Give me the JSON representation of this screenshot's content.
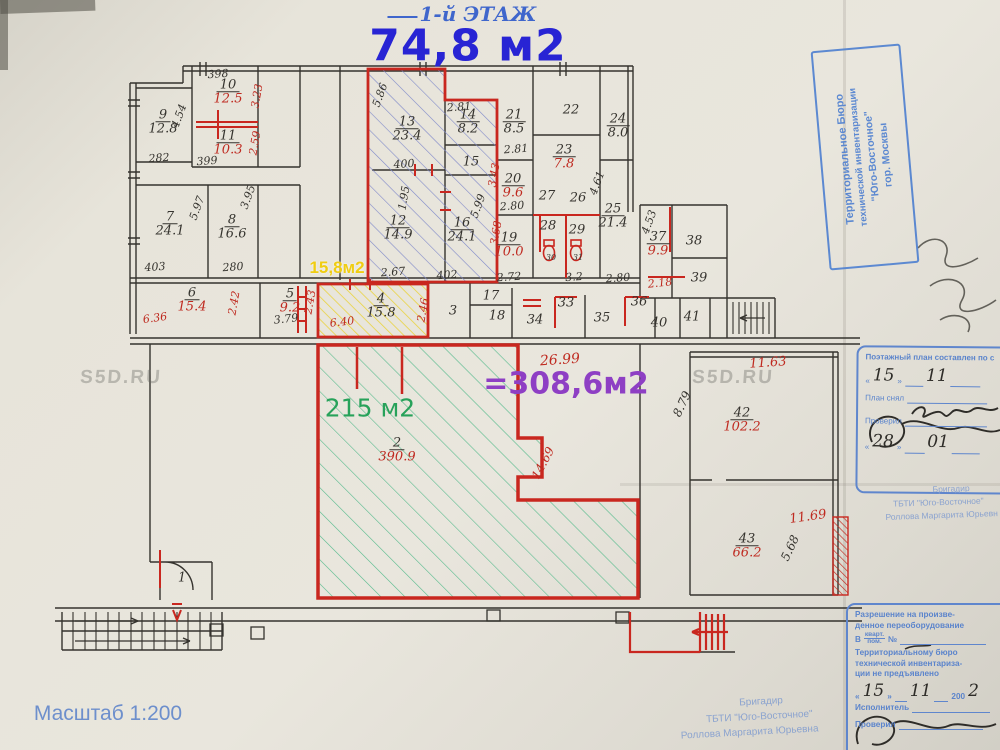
{
  "page": {
    "floor_label": "1-й ЭТАЖ",
    "floor_area": "74,8 м2",
    "scale_label": "Масштаб 1:200",
    "watermark": "S5D.RU"
  },
  "palette": {
    "ink": "#35332e",
    "red": "#bf2a20",
    "hand_blue": "#3f66cc",
    "stamp_blue": "#5b84cc",
    "green": "#27a25a",
    "purple": "#8e3fc4",
    "yellow": "#f0cd12"
  },
  "highlights": {
    "yellow_area": "15,8м2",
    "green_area": "215 м2",
    "purple_total": "=308,6м2"
  },
  "plan": {
    "rooms": [
      {
        "n": "9",
        "a": "12.8",
        "c": "ink",
        "x": 163,
        "y": 122
      },
      {
        "n": "10",
        "a": "12.5",
        "c": "red",
        "x": 228,
        "y": 92
      },
      {
        "n": "11",
        "a": "10.3",
        "c": "red",
        "x": 228,
        "y": 143
      },
      {
        "n": "7",
        "a": "24.1",
        "c": "ink",
        "x": 170,
        "y": 224
      },
      {
        "n": "8",
        "a": "16.6",
        "c": "ink",
        "x": 232,
        "y": 227
      },
      {
        "n": "13",
        "a": "23.4",
        "c": "ink",
        "x": 407,
        "y": 129
      },
      {
        "n": "14",
        "a": "8.2",
        "c": "ink",
        "x": 468,
        "y": 122
      },
      {
        "n": "15",
        "a": "",
        "c": "ink",
        "x": 471,
        "y": 162
      },
      {
        "n": "12",
        "a": "14.9",
        "c": "ink",
        "x": 398,
        "y": 228
      },
      {
        "n": "16",
        "a": "24.1",
        "c": "ink",
        "x": 462,
        "y": 230
      },
      {
        "n": "21",
        "a": "8.5",
        "c": "ink",
        "x": 514,
        "y": 122
      },
      {
        "n": "22",
        "a": "",
        "c": "ink",
        "x": 571,
        "y": 110
      },
      {
        "n": "23",
        "a": "7.8",
        "c": "red",
        "x": 564,
        "y": 157
      },
      {
        "n": "24",
        "a": "8.0",
        "c": "ink",
        "x": 618,
        "y": 126
      },
      {
        "n": "20",
        "a": "9.6",
        "c": "red",
        "x": 513,
        "y": 186
      },
      {
        "n": "27",
        "a": "",
        "c": "ink",
        "x": 547,
        "y": 196
      },
      {
        "n": "26",
        "a": "",
        "c": "ink",
        "x": 578,
        "y": 198
      },
      {
        "n": "25",
        "a": "21.4",
        "c": "ink",
        "x": 613,
        "y": 216
      },
      {
        "n": "19",
        "a": "10.0",
        "c": "red",
        "x": 509,
        "y": 245
      },
      {
        "n": "28",
        "a": "",
        "c": "ink",
        "x": 548,
        "y": 226
      },
      {
        "n": "29",
        "a": "",
        "c": "ink",
        "x": 577,
        "y": 230
      },
      {
        "n": "30",
        "a": "",
        "c": "ink",
        "x": 551,
        "y": 258,
        "s": 8
      },
      {
        "n": "31",
        "a": "",
        "c": "ink",
        "x": 578,
        "y": 258,
        "s": 8
      },
      {
        "n": "37",
        "a": "9.9",
        "c": "red",
        "x": 658,
        "y": 244
      },
      {
        "n": "38",
        "a": "",
        "c": "ink",
        "x": 694,
        "y": 241
      },
      {
        "n": "39",
        "a": "",
        "c": "ink",
        "x": 699,
        "y": 278
      },
      {
        "n": "6",
        "a": "15.4",
        "c": "red",
        "x": 192,
        "y": 300
      },
      {
        "n": "5",
        "a": "9.2",
        "c": "red",
        "x": 290,
        "y": 301
      },
      {
        "n": "4",
        "a": "15.8",
        "c": "ink",
        "x": 381,
        "y": 306
      },
      {
        "n": "3",
        "a": "",
        "c": "ink",
        "x": 453,
        "y": 311
      },
      {
        "n": "17",
        "a": "",
        "c": "ink",
        "x": 491,
        "y": 296
      },
      {
        "n": "18",
        "a": "",
        "c": "ink",
        "x": 497,
        "y": 316
      },
      {
        "n": "34",
        "a": "",
        "c": "ink",
        "x": 535,
        "y": 320
      },
      {
        "n": "33",
        "a": "",
        "c": "ink",
        "x": 566,
        "y": 303
      },
      {
        "n": "35",
        "a": "",
        "c": "ink",
        "x": 602,
        "y": 318
      },
      {
        "n": "36",
        "a": "",
        "c": "ink",
        "x": 639,
        "y": 302
      },
      {
        "n": "40",
        "a": "",
        "c": "ink",
        "x": 659,
        "y": 323
      },
      {
        "n": "41",
        "a": "",
        "c": "ink",
        "x": 692,
        "y": 317
      },
      {
        "n": "2",
        "a": "390.9",
        "c": "red",
        "x": 397,
        "y": 450
      },
      {
        "n": "42",
        "a": "102.2",
        "c": "red",
        "x": 742,
        "y": 420
      },
      {
        "n": "43",
        "a": "66.2",
        "c": "red",
        "x": 747,
        "y": 546
      },
      {
        "n": "1",
        "a": "",
        "c": "ink",
        "x": 182,
        "y": 578
      }
    ],
    "dims": [
      {
        "t": "398",
        "x": 218,
        "y": 74,
        "c": "ink",
        "r": -4
      },
      {
        "t": "3.23",
        "x": 257,
        "y": 96,
        "c": "red",
        "r": -80
      },
      {
        "t": "4.54",
        "x": 179,
        "y": 116,
        "c": "ink",
        "r": -70
      },
      {
        "t": "2.59",
        "x": 255,
        "y": 143,
        "c": "red",
        "r": -80
      },
      {
        "t": "282",
        "x": 159,
        "y": 158,
        "c": "ink",
        "r": -4
      },
      {
        "t": "399",
        "x": 207,
        "y": 161,
        "c": "ink",
        "r": -4
      },
      {
        "t": "5.97",
        "x": 197,
        "y": 208,
        "c": "ink",
        "r": -70
      },
      {
        "t": "3.95",
        "x": 248,
        "y": 197,
        "c": "ink",
        "r": -70
      },
      {
        "t": "403",
        "x": 155,
        "y": 267,
        "c": "ink",
        "r": -4
      },
      {
        "t": "280",
        "x": 233,
        "y": 267,
        "c": "ink",
        "r": -4
      },
      {
        "t": "5.86",
        "x": 380,
        "y": 95,
        "c": "ink",
        "r": -70
      },
      {
        "t": "400",
        "x": 404,
        "y": 164,
        "c": "ink",
        "r": -4
      },
      {
        "t": "2.81",
        "x": 459,
        "y": 107,
        "c": "ink",
        "r": -4
      },
      {
        "t": "1.95",
        "x": 404,
        "y": 198,
        "c": "ink",
        "r": -80
      },
      {
        "t": "5.99",
        "x": 478,
        "y": 206,
        "c": "ink",
        "r": -70
      },
      {
        "t": "2.67",
        "x": 393,
        "y": 272,
        "c": "ink",
        "r": -4
      },
      {
        "t": "402",
        "x": 447,
        "y": 275,
        "c": "ink",
        "r": -4
      },
      {
        "t": "3.43",
        "x": 494,
        "y": 175,
        "c": "red",
        "r": -80
      },
      {
        "t": "3.68",
        "x": 496,
        "y": 233,
        "c": "red",
        "r": -80
      },
      {
        "t": "2.81",
        "x": 516,
        "y": 149,
        "c": "ink",
        "r": -4
      },
      {
        "t": "2.80",
        "x": 512,
        "y": 206,
        "c": "ink",
        "r": -4
      },
      {
        "t": "4.61",
        "x": 597,
        "y": 183,
        "c": "ink",
        "r": -70
      },
      {
        "t": "2.72",
        "x": 509,
        "y": 277,
        "c": "ink",
        "r": -4
      },
      {
        "t": "3.2",
        "x": 574,
        "y": 277,
        "c": "ink",
        "r": -4
      },
      {
        "t": "2.80",
        "x": 618,
        "y": 278,
        "c": "ink",
        "r": -4
      },
      {
        "t": "4.53",
        "x": 649,
        "y": 222,
        "c": "ink",
        "r": -70
      },
      {
        "t": "2.18",
        "x": 660,
        "y": 283,
        "c": "red",
        "r": -6
      },
      {
        "t": "6.36",
        "x": 155,
        "y": 318,
        "c": "red",
        "r": -8
      },
      {
        "t": "2.42",
        "x": 234,
        "y": 303,
        "c": "red",
        "r": -80
      },
      {
        "t": "3.79",
        "x": 286,
        "y": 319,
        "c": "ink",
        "r": -6
      },
      {
        "t": "2.43",
        "x": 310,
        "y": 302,
        "c": "red",
        "r": -80
      },
      {
        "t": "6.40",
        "x": 342,
        "y": 322,
        "c": "red",
        "r": -6
      },
      {
        "t": "2.46",
        "x": 423,
        "y": 310,
        "c": "red",
        "r": -80
      },
      {
        "t": "26.99",
        "x": 560,
        "y": 360,
        "c": "red",
        "r": -4,
        "s": 14
      },
      {
        "t": "11.63",
        "x": 768,
        "y": 363,
        "c": "red",
        "r": -4,
        "s": 13
      },
      {
        "t": "8.79",
        "x": 682,
        "y": 404,
        "c": "ink",
        "r": -65,
        "s": 12
      },
      {
        "t": "11.69",
        "x": 808,
        "y": 517,
        "c": "red",
        "r": -8,
        "s": 13
      },
      {
        "t": "5.68",
        "x": 790,
        "y": 548,
        "c": "ink",
        "r": -65,
        "s": 12
      },
      {
        "t": "14.69",
        "x": 543,
        "y": 463,
        "c": "red",
        "r": -62,
        "s": 12
      }
    ]
  },
  "watermarks": [
    {
      "x": 121,
      "y": 378
    },
    {
      "x": 733,
      "y": 378
    }
  ],
  "stamps": {
    "top_right": {
      "lines": [
        "Территориальное Бюро",
        "технической инвентаризации",
        "\"Юго-Восточное\"",
        "гор. Москвы"
      ]
    },
    "plan_box": {
      "title": "Поэтажный план составлен по с",
      "q_open": "«",
      "q_close": "»",
      "date1_day": "15",
      "date1_month": "11",
      "row_snyal": "План снял",
      "row_proveril": "Проверил",
      "date2_day": "28",
      "date2_month": "01"
    },
    "brigadir_right": {
      "lines": [
        "Бригадир",
        "ТБТИ \"Юго-Восточное\"",
        "Роллова Маргарита Юрьевн"
      ]
    },
    "permission": {
      "lines": [
        "Разрешение на произве-",
        "денное переоборудование",
        "Территориальному бюро",
        "технической инвентариза-",
        "ции не предъявлено"
      ],
      "prefix": "В",
      "kvart": "кварт.",
      "pom": "пом.",
      "num_sign": "№",
      "date_day": "15",
      "date_month": "11",
      "year_print": "200",
      "year_hand": "2",
      "ispolnitel": "Исполнитель",
      "proveril": "Проверил"
    },
    "brigadir_bottom": {
      "lines": [
        "Бригадир",
        "ТБТИ \"Юго-Восточное\"",
        "Роллова Маргарита Юрьевна"
      ]
    }
  }
}
